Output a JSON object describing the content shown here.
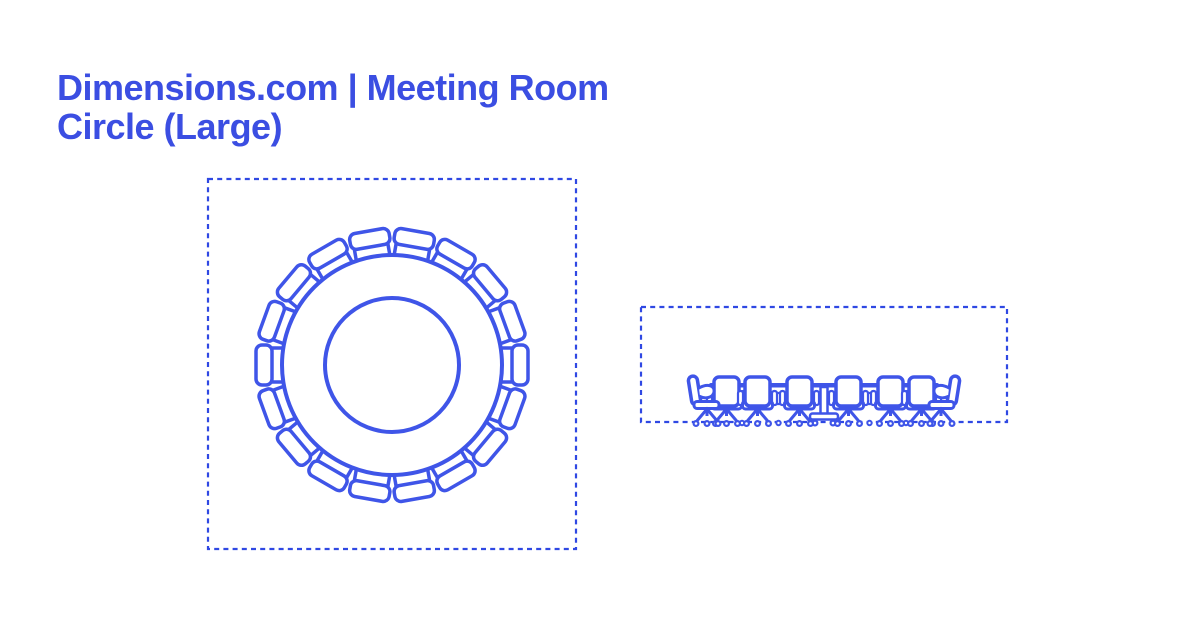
{
  "page": {
    "background": "#ffffff",
    "width": 1200,
    "height": 630
  },
  "header": {
    "title": "Dimensions.com | Meeting Room Circle (Large)",
    "title_lines": [
      "Dimensions.com | Meeting Room",
      "Circle (Large)"
    ],
    "title_color": "#3B4EE2"
  },
  "figure": {
    "stroke_color": "#3F55E8",
    "boundary_color": "#2F48E3",
    "fill_color": "#ffffff",
    "plan_view": {
      "view": "plan",
      "seat_count": 18,
      "table_shape": "circle"
    },
    "elevation_view": {
      "view": "elevation",
      "back_chair_count": 6,
      "profile_chair_count": 2
    }
  }
}
